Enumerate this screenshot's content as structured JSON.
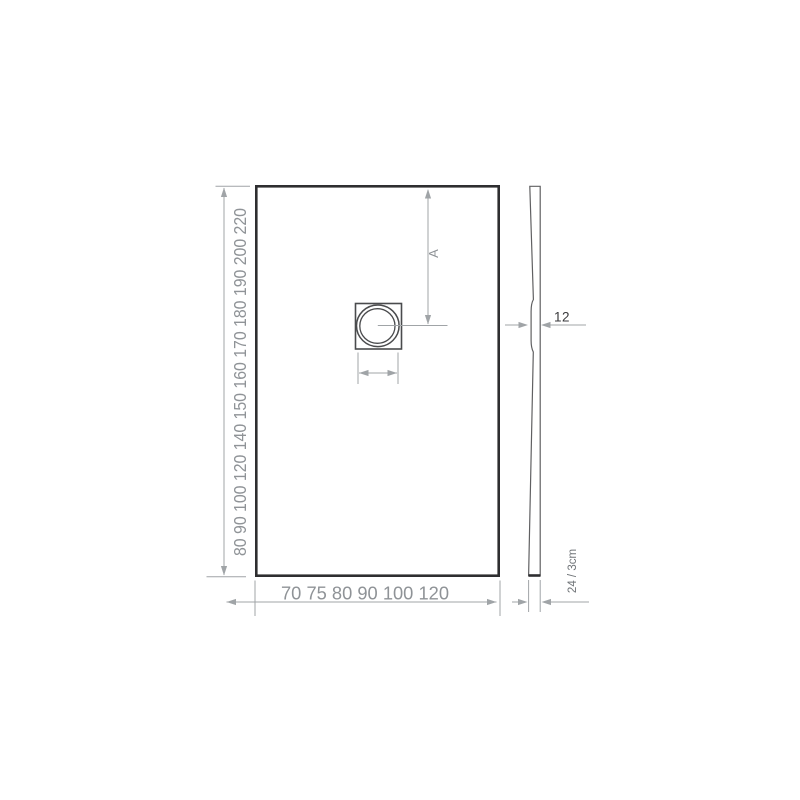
{
  "colors": {
    "background": "#ffffff",
    "outline": "#2e2e30",
    "drain_outline": "#4a4b4d",
    "profile_outline": "#606062",
    "dimension_gray": "#a0a4a7",
    "label_gray": "#8f9397",
    "label_dark": "#3a3a3c"
  },
  "plan_view": {
    "length_dimension": {
      "values": [
        80,
        90,
        100,
        120,
        140,
        150,
        160,
        170,
        180,
        190,
        200,
        220
      ],
      "label": "80 90 100 120 140 150 160 170 180 190 200 220"
    },
    "width_dimension": {
      "values": [
        70,
        75,
        80,
        90,
        100,
        120
      ],
      "label": "70 75 80 90 100 120"
    },
    "drain_offset_label": "A"
  },
  "side_view": {
    "drain_thickness_label": "12",
    "edge_height_label": "24 / 3cm"
  }
}
